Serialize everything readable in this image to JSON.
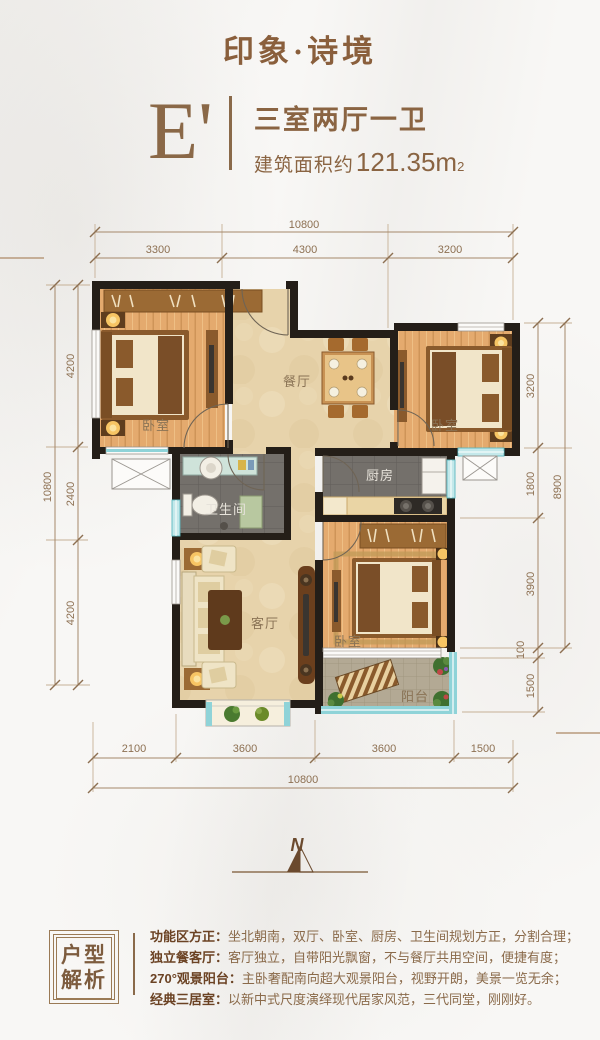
{
  "header": {
    "title": "印象·诗境",
    "unit_code": "E'",
    "layout_type": "三室两厅一卫",
    "area_prefix": "建筑面积约",
    "area_value": "121.35m",
    "area_sup": "2"
  },
  "dimensions": {
    "top_total": "10800",
    "top_segments": [
      "3300",
      "4300",
      "3200"
    ],
    "left_total": "10800",
    "left_segments": [
      "4200",
      "2400",
      "4200"
    ],
    "right_total": "8900",
    "right_segments": [
      "3200",
      "1800",
      "3900",
      "100",
      "1500"
    ],
    "bottom_segments": [
      "2100",
      "3600",
      "3600",
      "1500"
    ],
    "bottom_total": "10800"
  },
  "rooms": {
    "bedroom_nw": "卧室",
    "dining": "餐厅",
    "bedroom_ne": "卧室",
    "bathroom": "卫生间",
    "kitchen": "厨房",
    "living": "客厅",
    "bedroom_master": "卧室",
    "balcony": "阳台"
  },
  "compass": {
    "north": "N"
  },
  "analysis": {
    "box_title_line1": "户型",
    "box_title_line2": "解析",
    "items": [
      {
        "label": "功能区方正：",
        "text": "坐北朝南，双厅、卧室、厨房、卫生间规划方正，分割合理；"
      },
      {
        "label": "独立餐客厅：",
        "text": "客厅独立，自带阳光飘窗，不与餐厅共用空间，便捷有度；"
      },
      {
        "label": "270°观景阳台：",
        "text": "主卧奢配南向超大观景阳台，视野开朗，美景一览无余；"
      },
      {
        "label": "经典三居室：",
        "text": "以新中式尺度演绎现代居家风范，三代同堂，刚刚好。"
      }
    ]
  },
  "colors": {
    "accent_brown": "#8a5f3d",
    "dim_line": "#a5886a",
    "wall": "#241e18",
    "wood_floor": "#e4aa6e",
    "tile_beige": "#e7d3ab",
    "tile_gray": "#74706b",
    "window_teal": "#8fd3d8",
    "balcony_paver": "#b3a994"
  }
}
